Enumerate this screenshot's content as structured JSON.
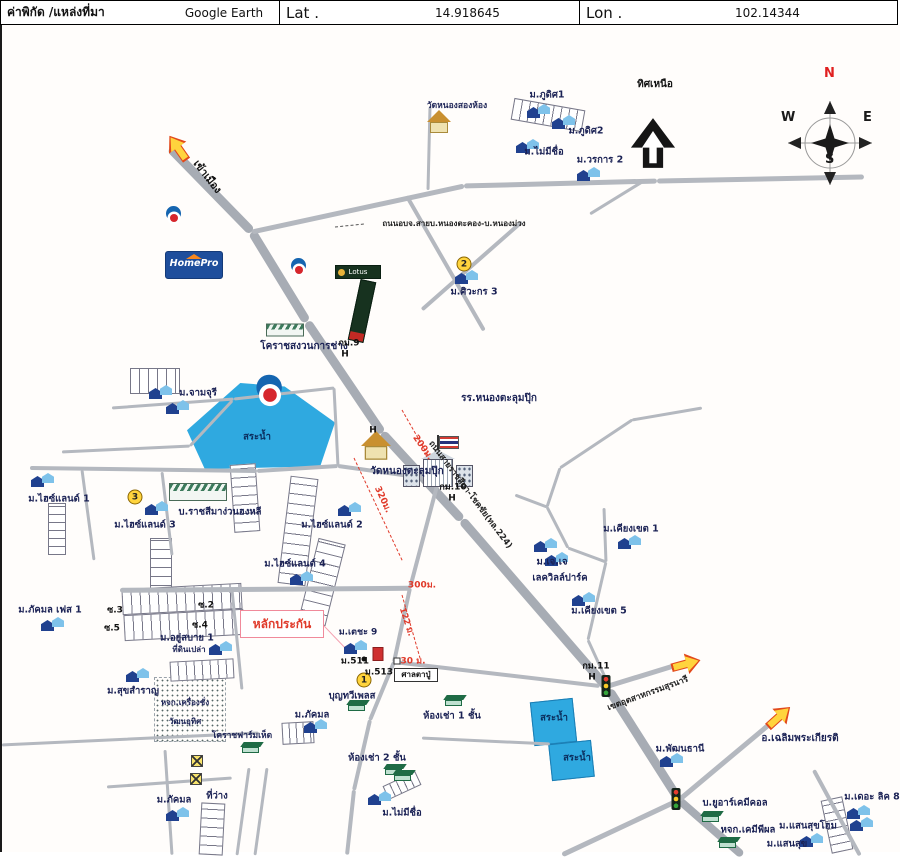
{
  "header": {
    "source_label": "ค่าพิกัด /แหล่งที่มา",
    "source_value": "Google Earth",
    "lat_label": "Lat .",
    "lat_value": "14.918645",
    "lon_label": "Lon .",
    "lon_value": "102.14344"
  },
  "colors": {
    "highway": "#a7acb4",
    "minor_road": "#b4b8bf",
    "pond": "#2fa9e0",
    "measure_red": "#e03a2a",
    "label_navy": "#1b2255",
    "badge_yellow": "#ffd43d"
  },
  "logos": {
    "homepro": "HomePro",
    "lotus": "Lotus"
  },
  "map": {
    "compass": {
      "n": "N",
      "e": "E",
      "w": "W",
      "s": "S"
    },
    "labels": [
      {
        "t": "เข้าเมือง",
        "x": 205,
        "y": 177,
        "r": 52,
        "s": 10.5,
        "c": "#111"
      },
      {
        "t": "วัดหนองสองห้อง",
        "x": 455,
        "y": 106,
        "s": 8.5
      },
      {
        "t": "ม.ภูดิศ1",
        "x": 545,
        "y": 95
      },
      {
        "t": "ม.ภูดิศ2",
        "x": 584,
        "y": 131
      },
      {
        "t": "ม.ไม่มีชื่อ",
        "x": 542,
        "y": 152
      },
      {
        "t": "ม.วรการ 2",
        "x": 598,
        "y": 160
      },
      {
        "t": "ทิศเหนือ",
        "x": 653,
        "y": 85,
        "s": 10,
        "c": "#111"
      },
      {
        "t": "ถนนอบจ.สายบ.หนองตะคอง-บ.หนองม่วง",
        "x": 452,
        "y": 224,
        "s": 8,
        "c": "#222"
      },
      {
        "t": "ม.ศิวะกร 3",
        "x": 472,
        "y": 292
      },
      {
        "t": "โคราชสงวนการช่าง",
        "x": 302,
        "y": 347,
        "s": 10
      },
      {
        "t": "กม.9",
        "x": 347,
        "y": 344,
        "s": 9,
        "c": "#111"
      },
      {
        "t": "H",
        "x": 343,
        "y": 355,
        "s": 9,
        "c": "#111"
      },
      {
        "t": "ม.จามจุรี",
        "x": 196,
        "y": 393
      },
      {
        "t": "สระน้ำ",
        "x": 255,
        "y": 437,
        "c": "#0b2e5e"
      },
      {
        "t": "รร.หนองตะลุมปุ๊ก",
        "x": 497,
        "y": 399,
        "s": 10
      },
      {
        "t": "H",
        "x": 371,
        "y": 431,
        "s": 9,
        "c": "#111"
      },
      {
        "t": "วัดหนองตะลุมปุ๊ก",
        "x": 405,
        "y": 472,
        "s": 10
      },
      {
        "t": "200ม.",
        "x": 420,
        "y": 448,
        "r": 55,
        "c": "#e03a2a",
        "s": 9
      },
      {
        "t": "320ม.",
        "x": 380,
        "y": 500,
        "r": 65,
        "c": "#e03a2a",
        "s": 9
      },
      {
        "t": "กม.10",
        "x": 451,
        "y": 488,
        "s": 9,
        "c": "#111"
      },
      {
        "t": "H",
        "x": 450,
        "y": 499,
        "s": 9,
        "c": "#111"
      },
      {
        "t": "ถนนสายราชสีมา-โชคชัย(ทล.224)",
        "x": 468,
        "y": 495,
        "r": 53,
        "s": 8.5,
        "c": "#222"
      },
      {
        "t": "ม.ไฮซ์แลนด์ 1",
        "x": 57,
        "y": 499
      },
      {
        "t": "ม.ไฮซ์แลนด์ 3",
        "x": 143,
        "y": 525
      },
      {
        "t": "บ.ราชสีมาง่วนฮงหลี",
        "x": 218,
        "y": 512
      },
      {
        "t": "ม.ไฮซ์แลนด์ 2",
        "x": 330,
        "y": 525
      },
      {
        "t": "ม.ไฮซ์แลนด์ 4",
        "x": 293,
        "y": 564
      },
      {
        "t": "ม.เคียงเขต 1",
        "x": 629,
        "y": 529
      },
      {
        "t": "ม.เจ.เจ",
        "x": 550,
        "y": 562
      },
      {
        "t": "เลควิลล์ปาร์ค",
        "x": 558,
        "y": 578
      },
      {
        "t": "ม.เคียงเขต 5",
        "x": 597,
        "y": 611
      },
      {
        "t": "ม.ภัคมล เฟส 1",
        "x": 48,
        "y": 610
      },
      {
        "t": "ซ.3",
        "x": 113,
        "y": 611,
        "s": 9,
        "c": "#111"
      },
      {
        "t": "ซ.5",
        "x": 110,
        "y": 629,
        "s": 9,
        "c": "#111"
      },
      {
        "t": "ซ.2",
        "x": 204,
        "y": 606,
        "s": 9,
        "c": "#111"
      },
      {
        "t": "ซ.4",
        "x": 198,
        "y": 626,
        "s": 9,
        "c": "#111"
      },
      {
        "t": "ม.อยู่สบาย 1",
        "x": 185,
        "y": 638
      },
      {
        "t": "ที่ดินเปล่า",
        "x": 187,
        "y": 650,
        "s": 8
      },
      {
        "t": "หลักประกัน",
        "x": 280,
        "y": 624,
        "s": 12,
        "c": "#e03a2a"
      },
      {
        "t": "ม.เตชะ 9",
        "x": 356,
        "y": 633,
        "s": 9
      },
      {
        "t": "ม.511",
        "x": 353,
        "y": 662,
        "s": 9,
        "c": "#111"
      },
      {
        "t": "ม.513",
        "x": 377,
        "y": 673,
        "s": 9,
        "c": "#111"
      },
      {
        "t": "30 ม.",
        "x": 411,
        "y": 662,
        "s": 9,
        "c": "#e03a2a"
      },
      {
        "t": "ศาลตาปู่",
        "x": 414,
        "y": 675,
        "s": 8,
        "c": "#111"
      },
      {
        "t": "บุญทวีเพลส",
        "x": 350,
        "y": 696
      },
      {
        "t": "122 ม.",
        "x": 404,
        "y": 622,
        "r": 72,
        "s": 8.5,
        "c": "#e03a2a"
      },
      {
        "t": "300ม.",
        "x": 420,
        "y": 586,
        "s": 9,
        "c": "#e03a2a"
      },
      {
        "t": "ม.สุขสำราญ",
        "x": 131,
        "y": 691
      },
      {
        "t": "หจก.เครื่องชั่ง",
        "x": 183,
        "y": 703,
        "s": 8
      },
      {
        "t": "วัฒนอุทิศ",
        "x": 183,
        "y": 722,
        "s": 8
      },
      {
        "t": "โคราชฟาร์มเห็ด",
        "x": 240,
        "y": 736,
        "s": 8.5
      },
      {
        "t": "ม.ภัคมล",
        "x": 310,
        "y": 715
      },
      {
        "t": "ห้องเช่า 1 ชั้น",
        "x": 450,
        "y": 716
      },
      {
        "t": "ห้องเช่า 2 ชั้น",
        "x": 375,
        "y": 758
      },
      {
        "t": "สระน้ำ",
        "x": 552,
        "y": 718,
        "c": "#0b2e5e"
      },
      {
        "t": "สระน้ำ",
        "x": 575,
        "y": 758,
        "c": "#0b2e5e"
      },
      {
        "t": "กม.11",
        "x": 594,
        "y": 667,
        "s": 9,
        "c": "#111"
      },
      {
        "t": "H",
        "x": 590,
        "y": 678,
        "s": 9,
        "c": "#111"
      },
      {
        "t": "เขตอุตสาหกรรมสุรนารี",
        "x": 646,
        "y": 694,
        "r": -20,
        "s": 8.5,
        "c": "#222"
      },
      {
        "t": "ม.พัฒนธานี",
        "x": 678,
        "y": 749
      },
      {
        "t": "อ.เฉลิมพระเกียรติ",
        "x": 798,
        "y": 739,
        "s": 10
      },
      {
        "t": "บ.ยูอาร์เคมีคอล",
        "x": 733,
        "y": 803
      },
      {
        "t": "หจก.เคมีพีผล",
        "x": 746,
        "y": 830
      },
      {
        "t": "ม.แสนสุขโฮม",
        "x": 806,
        "y": 826
      },
      {
        "t": "ม.แสนสุข",
        "x": 785,
        "y": 844
      },
      {
        "t": "ม.เดอะ ลิค 8",
        "x": 870,
        "y": 797
      },
      {
        "t": "ม.ภัคมล",
        "x": 172,
        "y": 800
      },
      {
        "t": "ที่ว่าง",
        "x": 215,
        "y": 796
      },
      {
        "t": "ม.ไม่มีชื่อ",
        "x": 400,
        "y": 813
      }
    ],
    "roads": [
      [
        168,
        148,
        250,
        232,
        9
      ],
      [
        250,
        232,
        305,
        322,
        9
      ],
      [
        305,
        322,
        380,
        433,
        9
      ],
      [
        380,
        433,
        460,
        520,
        9
      ],
      [
        460,
        520,
        607,
        690,
        9
      ],
      [
        607,
        690,
        677,
        800,
        9
      ],
      [
        677,
        800,
        740,
        855,
        8
      ],
      [
        250,
        232,
        462,
        186,
        5
      ],
      [
        462,
        186,
        655,
        181,
        5
      ],
      [
        655,
        181,
        862,
        177,
        5
      ],
      [
        640,
        182,
        588,
        214,
        3
      ],
      [
        428,
        107,
        426,
        190,
        3
      ],
      [
        405,
        196,
        482,
        330,
        3.5
      ],
      [
        520,
        222,
        420,
        310,
        3.5
      ],
      [
        110,
        408,
        232,
        399,
        3
      ],
      [
        60,
        452,
        188,
        446,
        3
      ],
      [
        188,
        446,
        230,
        401,
        3
      ],
      [
        232,
        399,
        332,
        388,
        3
      ],
      [
        332,
        388,
        336,
        466,
        3
      ],
      [
        28,
        468,
        255,
        471,
        4
      ],
      [
        255,
        471,
        336,
        466,
        4
      ],
      [
        336,
        466,
        436,
        480,
        4
      ],
      [
        80,
        470,
        92,
        560,
        3
      ],
      [
        160,
        472,
        170,
        555,
        3
      ],
      [
        118,
        590,
        408,
        588,
        4.5
      ],
      [
        408,
        588,
        436,
        482,
        4
      ],
      [
        230,
        590,
        240,
        690,
        3
      ],
      [
        408,
        588,
        392,
        662,
        4
      ],
      [
        392,
        662,
        368,
        720,
        4
      ],
      [
        368,
        720,
        352,
        790,
        4
      ],
      [
        352,
        790,
        345,
        855,
        4
      ],
      [
        392,
        662,
        598,
        686,
        4
      ],
      [
        420,
        738,
        548,
        744,
        3
      ],
      [
        600,
        688,
        678,
        664,
        5
      ],
      [
        677,
        800,
        775,
        718,
        5
      ],
      [
        677,
        800,
        560,
        855,
        5
      ],
      [
        812,
        770,
        858,
        855,
        3.5
      ],
      [
        0,
        745,
        257,
        733,
        3
      ],
      [
        163,
        750,
        170,
        855,
        3
      ],
      [
        105,
        787,
        230,
        778,
        3
      ],
      [
        247,
        768,
        235,
        855,
        3
      ],
      [
        265,
        768,
        253,
        855,
        3
      ],
      [
        558,
        468,
        545,
        507,
        3
      ],
      [
        545,
        507,
        513,
        495,
        3
      ],
      [
        545,
        507,
        566,
        548,
        3
      ],
      [
        566,
        548,
        604,
        562,
        3
      ],
      [
        604,
        562,
        602,
        508,
        3
      ],
      [
        604,
        562,
        586,
        640,
        3
      ],
      [
        586,
        640,
        608,
        688,
        3
      ],
      [
        558,
        468,
        630,
        420,
        3
      ],
      [
        630,
        420,
        700,
        408,
        3
      ],
      [
        400,
        410,
        440,
        480,
        1,
        "#e03a2a",
        1
      ],
      [
        352,
        458,
        400,
        560,
        1,
        "#e03a2a",
        1
      ],
      [
        400,
        595,
        418,
        658,
        1,
        "#e03a2a",
        1
      ],
      [
        322,
        626,
        343,
        648,
        1.2,
        "#f4a0b0"
      ],
      [
        333,
        227,
        362,
        224,
        1,
        "#555",
        1
      ]
    ],
    "grids": [
      {
        "x": 510,
        "y": 104,
        "w": 70,
        "h": 20,
        "r": 10,
        "d": "v",
        "c": 8
      },
      {
        "x": 128,
        "y": 368,
        "w": 48,
        "h": 24,
        "r": 0,
        "d": "v",
        "c": 9
      },
      {
        "x": 230,
        "y": 464,
        "w": 24,
        "h": 66,
        "r": -4,
        "d": "h",
        "c": 9
      },
      {
        "x": 282,
        "y": 477,
        "w": 26,
        "h": 106,
        "r": 7,
        "d": "h",
        "c": 10
      },
      {
        "x": 306,
        "y": 540,
        "w": 26,
        "h": 82,
        "r": 14,
        "d": "h",
        "c": 10
      },
      {
        "x": 46,
        "y": 503,
        "w": 16,
        "h": 50,
        "r": 0,
        "d": "h",
        "c": 8
      },
      {
        "x": 148,
        "y": 538,
        "w": 20,
        "h": 55,
        "r": 0,
        "d": "h",
        "c": 9
      },
      {
        "x": 120,
        "y": 586,
        "w": 118,
        "h": 24,
        "r": -3,
        "d": "v",
        "c": 9
      },
      {
        "x": 122,
        "y": 612,
        "w": 118,
        "h": 24,
        "r": -3,
        "d": "v",
        "c": 9
      },
      {
        "x": 168,
        "y": 660,
        "w": 62,
        "h": 18,
        "r": -3,
        "d": "v",
        "c": 8
      },
      {
        "x": 280,
        "y": 722,
        "w": 30,
        "h": 20,
        "r": -3,
        "d": "v",
        "c": 7
      },
      {
        "x": 198,
        "y": 803,
        "w": 22,
        "h": 50,
        "r": 3,
        "d": "h",
        "c": 9
      },
      {
        "x": 382,
        "y": 778,
        "w": 34,
        "h": 13,
        "r": -25,
        "d": "v",
        "c": 7
      },
      {
        "x": 824,
        "y": 798,
        "w": 20,
        "h": 52,
        "r": -12,
        "d": "h",
        "c": 8
      }
    ],
    "dotted_fields": [
      {
        "x": 152,
        "y": 677,
        "w": 70,
        "h": 63
      }
    ],
    "ponds": [
      {
        "x": 185,
        "y": 383,
        "w": 148,
        "h": 86,
        "clip": "polygon(36% 0%,66% 4%,100% 46%,90% 97%,12% 100%,0% 55%)"
      },
      {
        "x": 530,
        "y": 700,
        "w": 43,
        "h": 44,
        "r": -6
      },
      {
        "x": 548,
        "y": 742,
        "w": 43,
        "h": 37,
        "r": -6
      }
    ],
    "boxes": [
      {
        "x": 238,
        "y": 610,
        "w": 84,
        "h": 28,
        "bc": "#f08a9b",
        "bw": 1.5
      },
      {
        "x": 392,
        "y": 668,
        "w": 44,
        "h": 14,
        "bc": "#333",
        "bw": 1
      }
    ],
    "icons": [
      {
        "t": "flame",
        "x": 172,
        "y": 215
      },
      {
        "t": "flame",
        "x": 297,
        "y": 267
      },
      {
        "t": "flame",
        "x": 268,
        "y": 390,
        "s": 1.7
      },
      {
        "t": "temple",
        "x": 437,
        "y": 122
      },
      {
        "t": "temple",
        "x": 374,
        "y": 446,
        "s": 1.25
      },
      {
        "t": "circle",
        "n": "2",
        "x": 462,
        "y": 264
      },
      {
        "t": "circle",
        "n": "3",
        "x": 133,
        "y": 497
      },
      {
        "t": "circle",
        "n": "1",
        "x": 362,
        "y": 680
      },
      {
        "t": "traffic",
        "x": 604,
        "y": 686
      },
      {
        "t": "traffic",
        "x": 674,
        "y": 799
      },
      {
        "t": "transformer",
        "x": 195,
        "y": 761
      },
      {
        "t": "transformer",
        "x": 194,
        "y": 779
      },
      {
        "t": "arrow",
        "x": 176,
        "y": 148,
        "r": -125
      },
      {
        "t": "arrow",
        "x": 684,
        "y": 664,
        "r": -15
      },
      {
        "t": "arrow",
        "x": 777,
        "y": 717,
        "r": -42
      },
      {
        "t": "green",
        "x": 355,
        "y": 706
      },
      {
        "t": "green",
        "x": 452,
        "y": 701
      },
      {
        "t": "green",
        "x": 392,
        "y": 770
      },
      {
        "t": "green",
        "x": 249,
        "y": 748
      },
      {
        "t": "green",
        "x": 709,
        "y": 817
      },
      {
        "t": "green",
        "x": 726,
        "y": 843
      },
      {
        "t": "green",
        "x": 401,
        "y": 776
      },
      {
        "t": "factory",
        "x": 196,
        "y": 492,
        "w": 58,
        "h": 18
      },
      {
        "t": "factory",
        "x": 283,
        "y": 330,
        "w": 38,
        "h": 13
      },
      {
        "t": "redbldg",
        "x": 376,
        "y": 654
      },
      {
        "t": "dot",
        "x": 362,
        "y": 659
      },
      {
        "t": "sq",
        "x": 395,
        "y": 661
      },
      {
        "t": "houses",
        "x": 538,
        "y": 111
      },
      {
        "t": "houses",
        "x": 563,
        "y": 122
      },
      {
        "t": "houses",
        "x": 527,
        "y": 146
      },
      {
        "t": "houses",
        "x": 588,
        "y": 174
      },
      {
        "t": "houses",
        "x": 466,
        "y": 277
      },
      {
        "t": "houses",
        "x": 160,
        "y": 392
      },
      {
        "t": "houses",
        "x": 177,
        "y": 407
      },
      {
        "t": "houses",
        "x": 42,
        "y": 480
      },
      {
        "t": "houses",
        "x": 156,
        "y": 508
      },
      {
        "t": "houses",
        "x": 349,
        "y": 509
      },
      {
        "t": "houses",
        "x": 301,
        "y": 578
      },
      {
        "t": "houses",
        "x": 629,
        "y": 542
      },
      {
        "t": "houses",
        "x": 545,
        "y": 545
      },
      {
        "t": "houses",
        "x": 556,
        "y": 559
      },
      {
        "t": "houses",
        "x": 583,
        "y": 599
      },
      {
        "t": "houses",
        "x": 52,
        "y": 624
      },
      {
        "t": "houses",
        "x": 220,
        "y": 648
      },
      {
        "t": "houses",
        "x": 137,
        "y": 675
      },
      {
        "t": "houses",
        "x": 355,
        "y": 647
      },
      {
        "t": "houses",
        "x": 315,
        "y": 726
      },
      {
        "t": "houses",
        "x": 671,
        "y": 760
      },
      {
        "t": "houses",
        "x": 811,
        "y": 840
      },
      {
        "t": "houses",
        "x": 858,
        "y": 812
      },
      {
        "t": "houses",
        "x": 861,
        "y": 824
      },
      {
        "t": "houses",
        "x": 379,
        "y": 798
      },
      {
        "t": "houses",
        "x": 177,
        "y": 814
      }
    ]
  }
}
